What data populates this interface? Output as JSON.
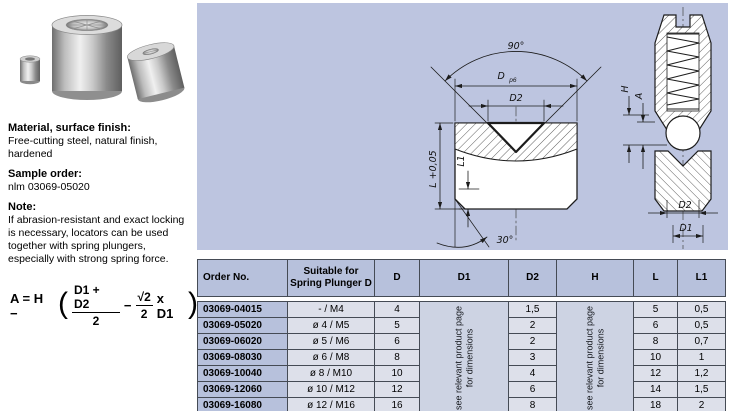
{
  "colors": {
    "panel_bg": "#bdc5e0",
    "header_bg": "#b7c1dc",
    "note_bg": "#cdd3e3",
    "cell_bg": "#dde0ea",
    "border": "#454b55"
  },
  "left": {
    "material_heading": "Material, surface finish:",
    "material_body": "Free-cutting steel, natural finish,\nhardened",
    "sample_heading": "Sample order:",
    "sample_body": "nlm 03069-05020",
    "note_heading": "Note:",
    "note_body": "If abrasion-resistant and exact locking\nis necessary, locators can be used\ntogether with spring plungers,\nespecially with strong spring force."
  },
  "formula": {
    "prefix": "A = H −",
    "open": "(",
    "num1": "D1 + D2",
    "den1": "2",
    "minus": "−",
    "num2": "√2",
    "den2": "2",
    "suffix": "x D1",
    "close": ")"
  },
  "drawing": {
    "labels": {
      "angle90": "90°",
      "dia": "D",
      "dia_tol": "p6",
      "d2": "D2",
      "l": "L +0,05",
      "l1": "L1",
      "angle30": "30°",
      "h": "H",
      "a": "A",
      "d2_right": "D2",
      "d1_right": "D1"
    }
  },
  "table": {
    "headers": [
      "Order No.",
      "Suitable for Spring Plunger D",
      "D",
      "D1",
      "D2",
      "H",
      "L",
      "L1"
    ],
    "note_line1": "see relevant product page",
    "note_line2": "for dimensions",
    "rows": [
      {
        "order": "03069-04015",
        "plunger": "- / M4",
        "d": "4",
        "d2": "1,5",
        "l": "5",
        "l1": "0,5"
      },
      {
        "order": "03069-05020",
        "plunger": "ø 4 / M5",
        "d": "5",
        "d2": "2",
        "l": "6",
        "l1": "0,5"
      },
      {
        "order": "03069-06020",
        "plunger": "ø 5 / M6",
        "d": "6",
        "d2": "2",
        "l": "8",
        "l1": "0,7"
      },
      {
        "order": "03069-08030",
        "plunger": "ø 6 / M8",
        "d": "8",
        "d2": "3",
        "l": "10",
        "l1": "1"
      },
      {
        "order": "03069-10040",
        "plunger": "ø 8 / M10",
        "d": "10",
        "d2": "4",
        "l": "12",
        "l1": "1,2"
      },
      {
        "order": "03069-12060",
        "plunger": "ø 10 / M12",
        "d": "12",
        "d2": "6",
        "l": "14",
        "l1": "1,5"
      },
      {
        "order": "03069-16080",
        "plunger": "ø 12 / M16",
        "d": "16",
        "d2": "8",
        "l": "18",
        "l1": "2"
      }
    ]
  }
}
